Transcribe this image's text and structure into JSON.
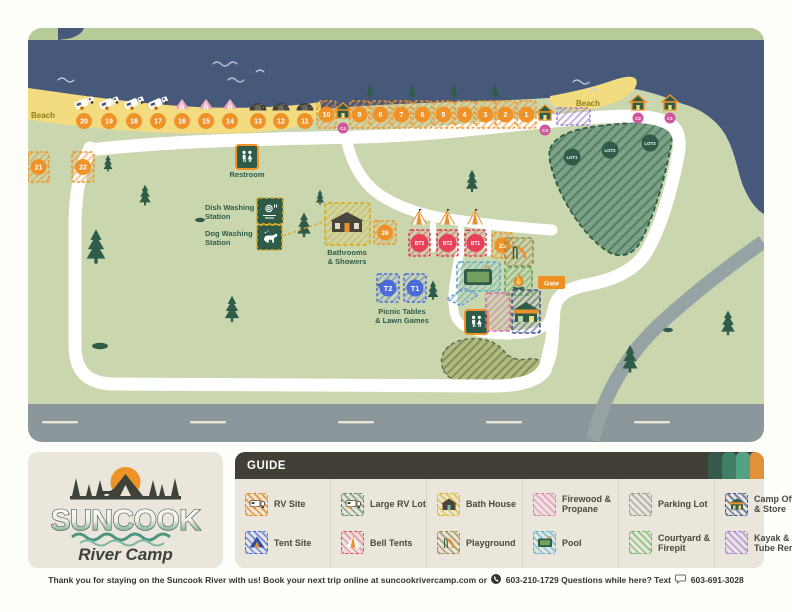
{
  "map": {
    "beach_label_left": "Beach",
    "beach_label_right": "Beach",
    "gate_label": "Gate",
    "restroom_label": "Restroom",
    "dish_line1": "Dish Washing",
    "dish_line2": "Station",
    "dog_line1": "Dog Washing",
    "dog_line2": "Station",
    "bath_line1": "Bathrooms",
    "bath_line2": "& Showers",
    "picnic_line1": "Picnic Tables",
    "picnic_line2": "& Lawn Games",
    "beach_sites": [
      "20",
      "19",
      "18",
      "17",
      "16",
      "15",
      "14",
      "13",
      "12",
      "11"
    ],
    "rv_sites": [
      "10",
      "9",
      "8",
      "7",
      "6",
      "5",
      "4",
      "3",
      "2",
      "1"
    ],
    "west_sites": [
      "21",
      "22"
    ],
    "site_26": "26",
    "site_23": "23",
    "bell_tents": [
      "BT3",
      "BT2",
      "BT1"
    ],
    "tent_sites": [
      "T2",
      "T1"
    ],
    "cabins": [
      "C4",
      "C3",
      "C2",
      "C1"
    ],
    "parking_lots": [
      "LOT1",
      "LOT2",
      "LOT3"
    ]
  },
  "logo": {
    "title": "SUNCOOK",
    "subtitle": "River Camp"
  },
  "guide": {
    "title": "GUIDE",
    "items": [
      {
        "label": "RV Site"
      },
      {
        "label": "Tent Site"
      },
      {
        "label": "Large RV Lot"
      },
      {
        "label": "Bell Tents"
      },
      {
        "label": "Bath House"
      },
      {
        "label": "Playground"
      },
      {
        "label": "Firewood & Propane"
      },
      {
        "label": "Pool"
      },
      {
        "label": "Parking Lot"
      },
      {
        "label": "Courtyard & Firepit"
      },
      {
        "label": "Camp Office & Store"
      },
      {
        "label": "Kayak & Tube Rental"
      }
    ]
  },
  "footer": {
    "part1": "Thank you for staying on the Suncook River with us! Book your next trip online at suncookrivercamp.com or",
    "phone1": "603-210-1729",
    "part2": "Questions while here? Text",
    "phone2": "603-691-3028"
  },
  "colors": {
    "map_ground": "#c9d6ae",
    "river": "#47597b",
    "sand": "#f3dc80",
    "pine": "#2e5c49",
    "orange": "#ef9329",
    "cabin_badge_pink": "#cf569e",
    "bell_tent_red": "#e8405a",
    "tent_blue": "#4d6bd8",
    "panel_beige": "#eae6dc",
    "guide_bar": "#424036",
    "tab_colors": [
      "#35594b",
      "#3f7f63",
      "#55a184",
      "#e0913a"
    ]
  }
}
